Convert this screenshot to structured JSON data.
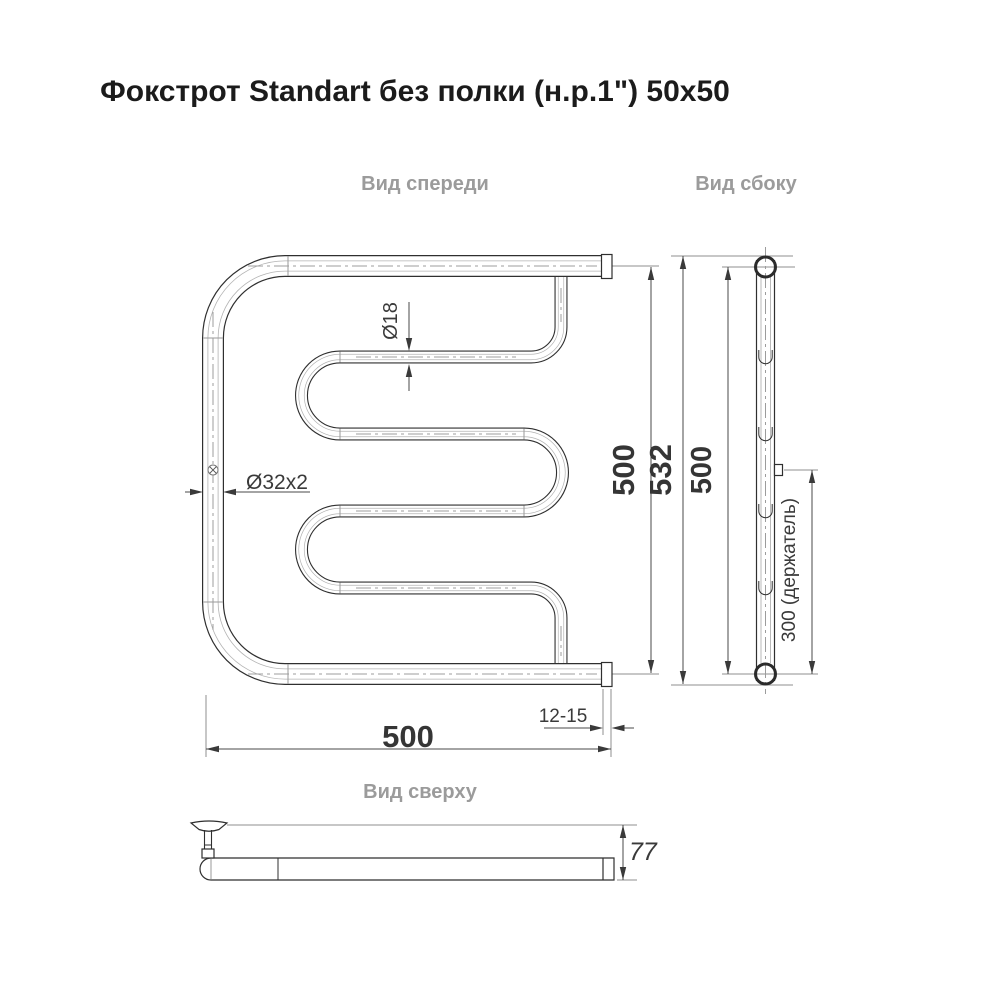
{
  "page": {
    "title": "Фокстрот Standart без полки (н.р.1\") 50x50"
  },
  "views": {
    "front_label": "Вид спереди",
    "side_label": "Вид сбоку",
    "top_label": "Вид сверху"
  },
  "dimensions": {
    "small_pipe_diameter": "Ø18",
    "main_pipe_diameter": "Ø32x2",
    "front_center_height": "500",
    "front_overall_height": "532",
    "front_width": "500",
    "end_cap_offset": "12-15",
    "side_center_height": "500",
    "holder_spacing": "300 (держатель)",
    "top_depth": "77"
  },
  "colors": {
    "outline": "#2f2f2f",
    "extension_line": "#8f8f8f",
    "centerline": "#9c9c9c",
    "dimension_text": "#3a3a3a",
    "view_label_text": "#9b9b9b",
    "title_text": "#1b1b1b",
    "background": "#ffffff"
  }
}
